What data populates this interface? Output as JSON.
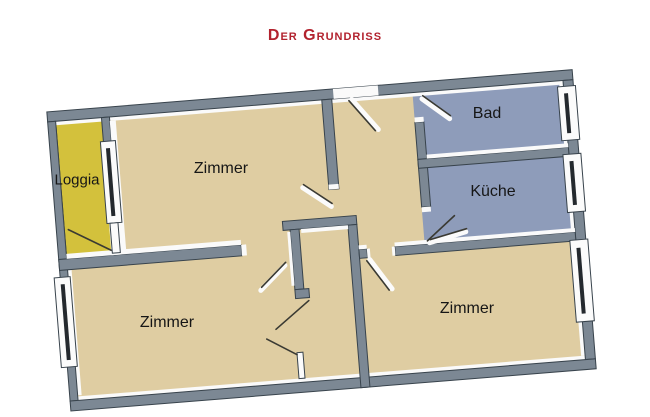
{
  "title": "Der Grundriss",
  "plan": {
    "colors": {
      "title_red": "#B2222E",
      "label_text": "#161616",
      "wall": "#7C8894",
      "wall_outline": "#38434C",
      "floor_beige": "#DFCDA2",
      "floor_blue": "#8E9CBA",
      "floor_yellow": "#D3C13C",
      "highlight_white": "#FAFAFA"
    },
    "rooms": [
      {
        "id": "loggia",
        "label": "Loggia"
      },
      {
        "id": "zimmer-top",
        "label": "Zimmer"
      },
      {
        "id": "bad",
        "label": "Bad"
      },
      {
        "id": "kueche",
        "label": "Küche"
      },
      {
        "id": "zimmer-bottom-left",
        "label": "Zimmer"
      },
      {
        "id": "zimmer-bottom-right",
        "label": "Zimmer"
      }
    ]
  }
}
